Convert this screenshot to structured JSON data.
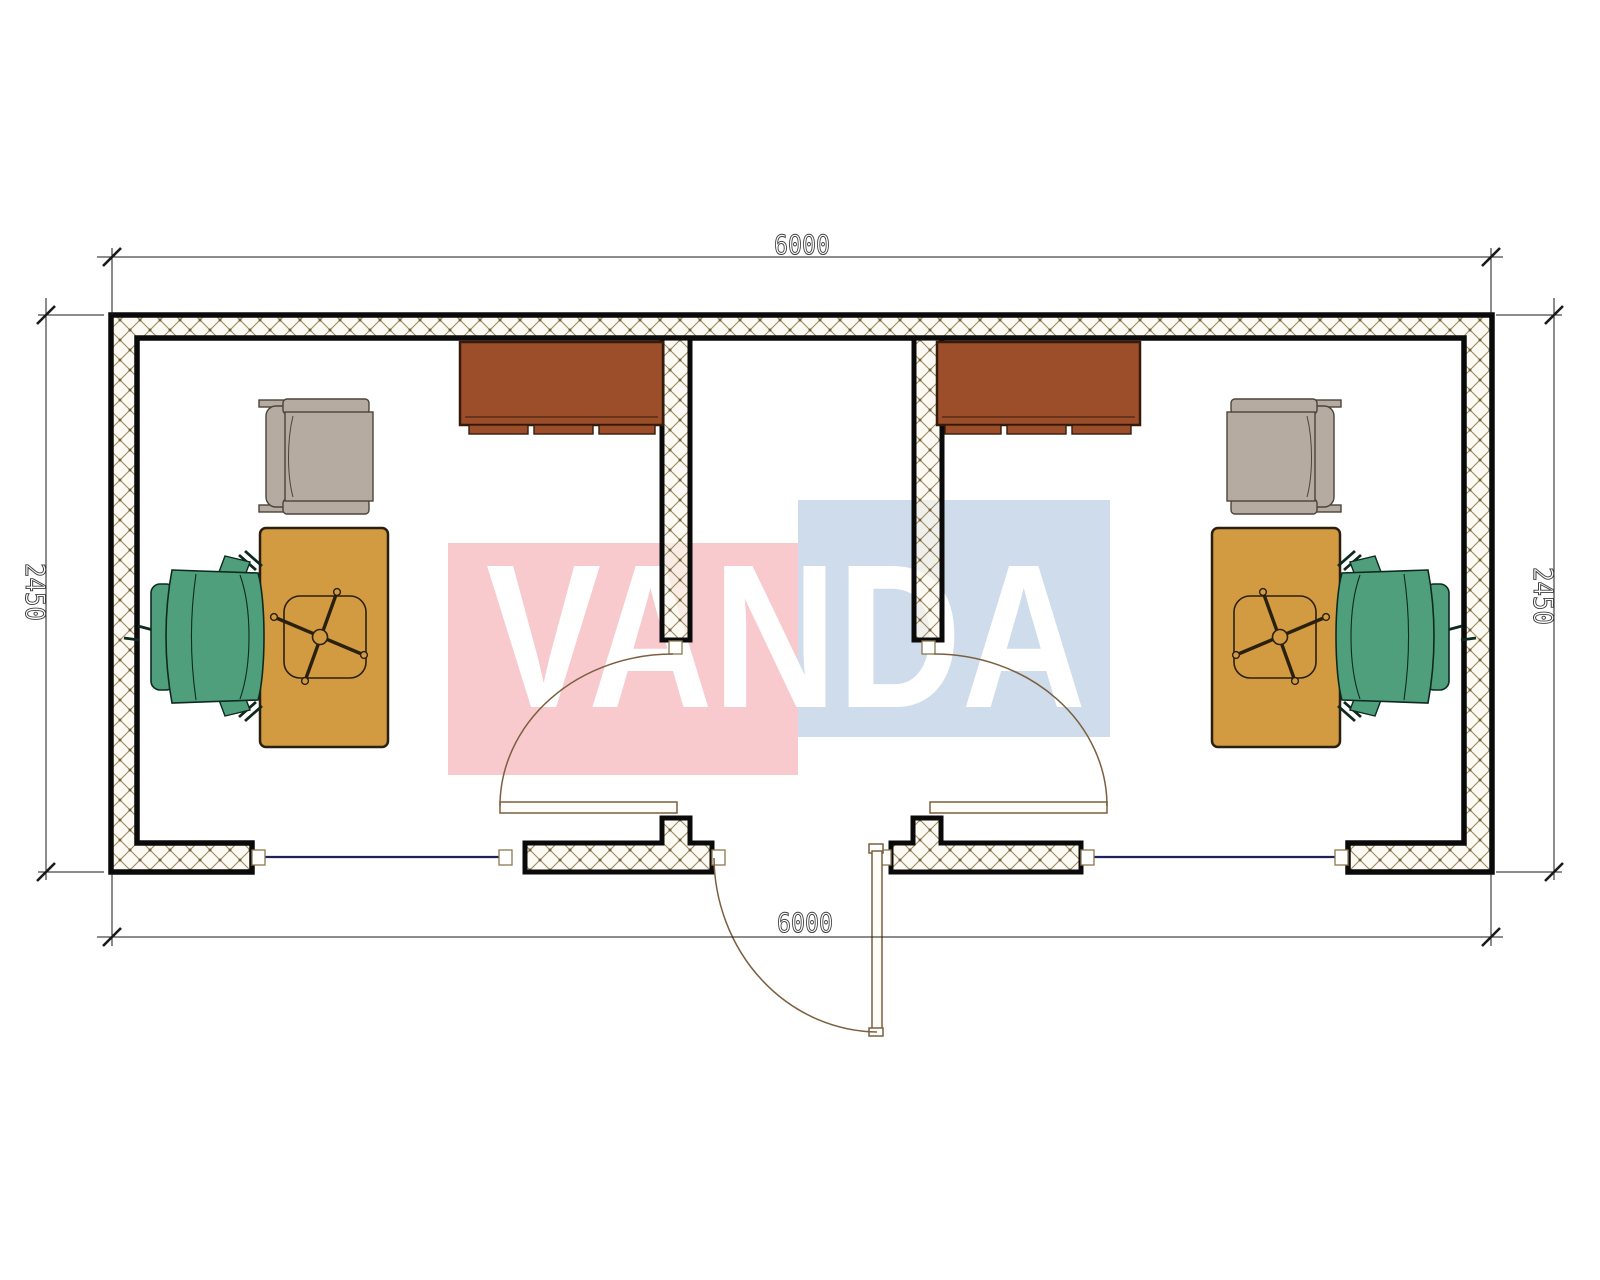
{
  "drawing": {
    "type": "architectural-floor-plan",
    "subject": "modular office container, two offices with central corridor, top view"
  },
  "watermark": {
    "text": "VANDA",
    "pink_color": "#f8cacd",
    "blue_color": "#cfdceb",
    "letter_color": "#ffffff"
  },
  "dimensions": {
    "top": {
      "label": "6000"
    },
    "bottom": {
      "label": "6000"
    },
    "left": {
      "label": "2450"
    },
    "right": {
      "label": "2450"
    }
  },
  "colors": {
    "wall_outline": "#0a0a0a",
    "hatch_line": "#9b8b63",
    "hatch_dot": "#6f5f3f",
    "hatch_bg": "#fcf8ee",
    "cabinet_brown": "#9c4e2a",
    "cabinet_edge": "#351b0b",
    "desk_tan": "#d29a41",
    "desk_edge": "#2a2010",
    "chair_green": "#4f9f7d",
    "chair_green_edge": "#0e2a1f",
    "armchair_gray": "#b6aba0",
    "armchair_edge": "#4a443c",
    "window_line": "#20205a",
    "door_line": "#7b5f3f",
    "dimension_line": "#1a1a1a",
    "dimension_text": "#3f3f3f",
    "cap_edge": "#8a7a50"
  },
  "rooms": [
    {
      "name": "office-left",
      "furniture": [
        "wall-cabinet",
        "armchair",
        "desk",
        "swivel-chair-base",
        "office-chair"
      ]
    },
    {
      "name": "corridor",
      "features": [
        "entrance-door",
        "interior-door-left",
        "interior-door-right"
      ]
    },
    {
      "name": "office-right",
      "furniture": [
        "wall-cabinet",
        "armchair",
        "desk",
        "swivel-chair-base",
        "office-chair"
      ]
    }
  ]
}
